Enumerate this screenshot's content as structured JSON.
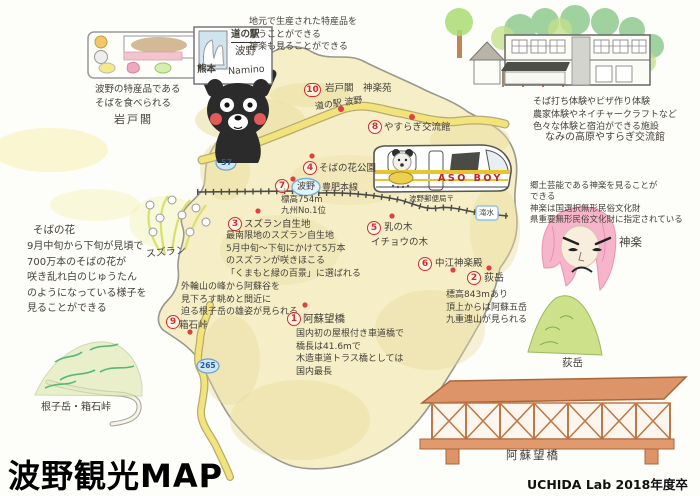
{
  "title": "波野観光MAP",
  "credit": "UCHIDA Lab  2018年度卒業生作成",
  "notes": {
    "tray": "波野の特産品である\nそばを食べられる",
    "tray_place": "岩戸閣",
    "michinoeki": "地元で生産された特産品を\n買うことができる\n神楽も見ることができる",
    "yasuragi": "そば打ち体験やピザ作り体験\n農家体験やネイチャークラフトなど\n色々な体験と宿泊ができる施設",
    "yasuragi_place": "なみの高原やすらぎ交流館",
    "soba_title": "そばの花",
    "soba_body": "9月中旬から下旬が見頃で\n700万本のそばの花が\n咲き乱れ白のじゅうたん\nのようになっている様子を\n見ることができる",
    "kagura": "郷土芸能である神楽を見ることが\nできる\n神楽は国選択無形民俗文化財\n県重要無形民俗文化財に指定されている",
    "kagura_label": "神楽",
    "suzuran_label": "スズラン",
    "hakoishi_view": "外輪山の峰から阿蘇谷を\n見下ろす眺めと間近に\n迫る根子岳の雄姿が見られる",
    "nekodake_label": "根子岳・箱石峠",
    "ogidake_label": "荻岳",
    "bridge_label": "阿蘇望橋"
  },
  "sign": {
    "top": "道の駅",
    "name": "波野",
    "pref": "熊本",
    "romaji": "Namino"
  },
  "pois": {
    "p1": {
      "num": "1",
      "name": "阿蘇望橋",
      "desc": "国内初の屋根付き車道橋で\n橋長は41.6mで\n木造車道トラス橋としては\n国内最長"
    },
    "p2": {
      "num": "2",
      "name": "荻岳",
      "desc": "標高843mあり\n頂上からは阿蘇五岳\n九重連山が見られる"
    },
    "p3": {
      "num": "3",
      "name": "スズラン自生地",
      "desc": "最南限地のスズラン自生地\n5月中旬〜下旬にかけて5万本\nのスズランが咲きほこる\n「くまもと緑の百景」に選ばれる"
    },
    "p4": {
      "num": "4",
      "name": "そばの花公園"
    },
    "p5": {
      "num": "5",
      "name": "乳の木",
      "sub": "イチョウの木"
    },
    "p6": {
      "num": "6",
      "name": "中江神楽殿"
    },
    "p7": {
      "num": "7",
      "name": "波野",
      "line": "豊肥本線",
      "desc": "標高754m\n九州No.1位"
    },
    "p8": {
      "num": "8",
      "name": "やすらぎ交流館"
    },
    "p9": {
      "num": "9",
      "name": "箱石峠"
    },
    "p10": {
      "num": "10",
      "name": "岩戸閣　神楽苑",
      "sub": "道の駅 波野"
    }
  },
  "rail": {
    "post_office": "波野郵便局〒",
    "next_station": "滝水"
  },
  "train": {
    "name": "ASO BOY"
  },
  "badges": {
    "r57": "57",
    "r265": "265"
  },
  "colors": {
    "map_fill": "#f5eec6",
    "road": "#f2e47b",
    "marker_red": "#d92b2b",
    "badge_blue": "#cfe6f5",
    "bridge_orange": "#dd9468"
  }
}
